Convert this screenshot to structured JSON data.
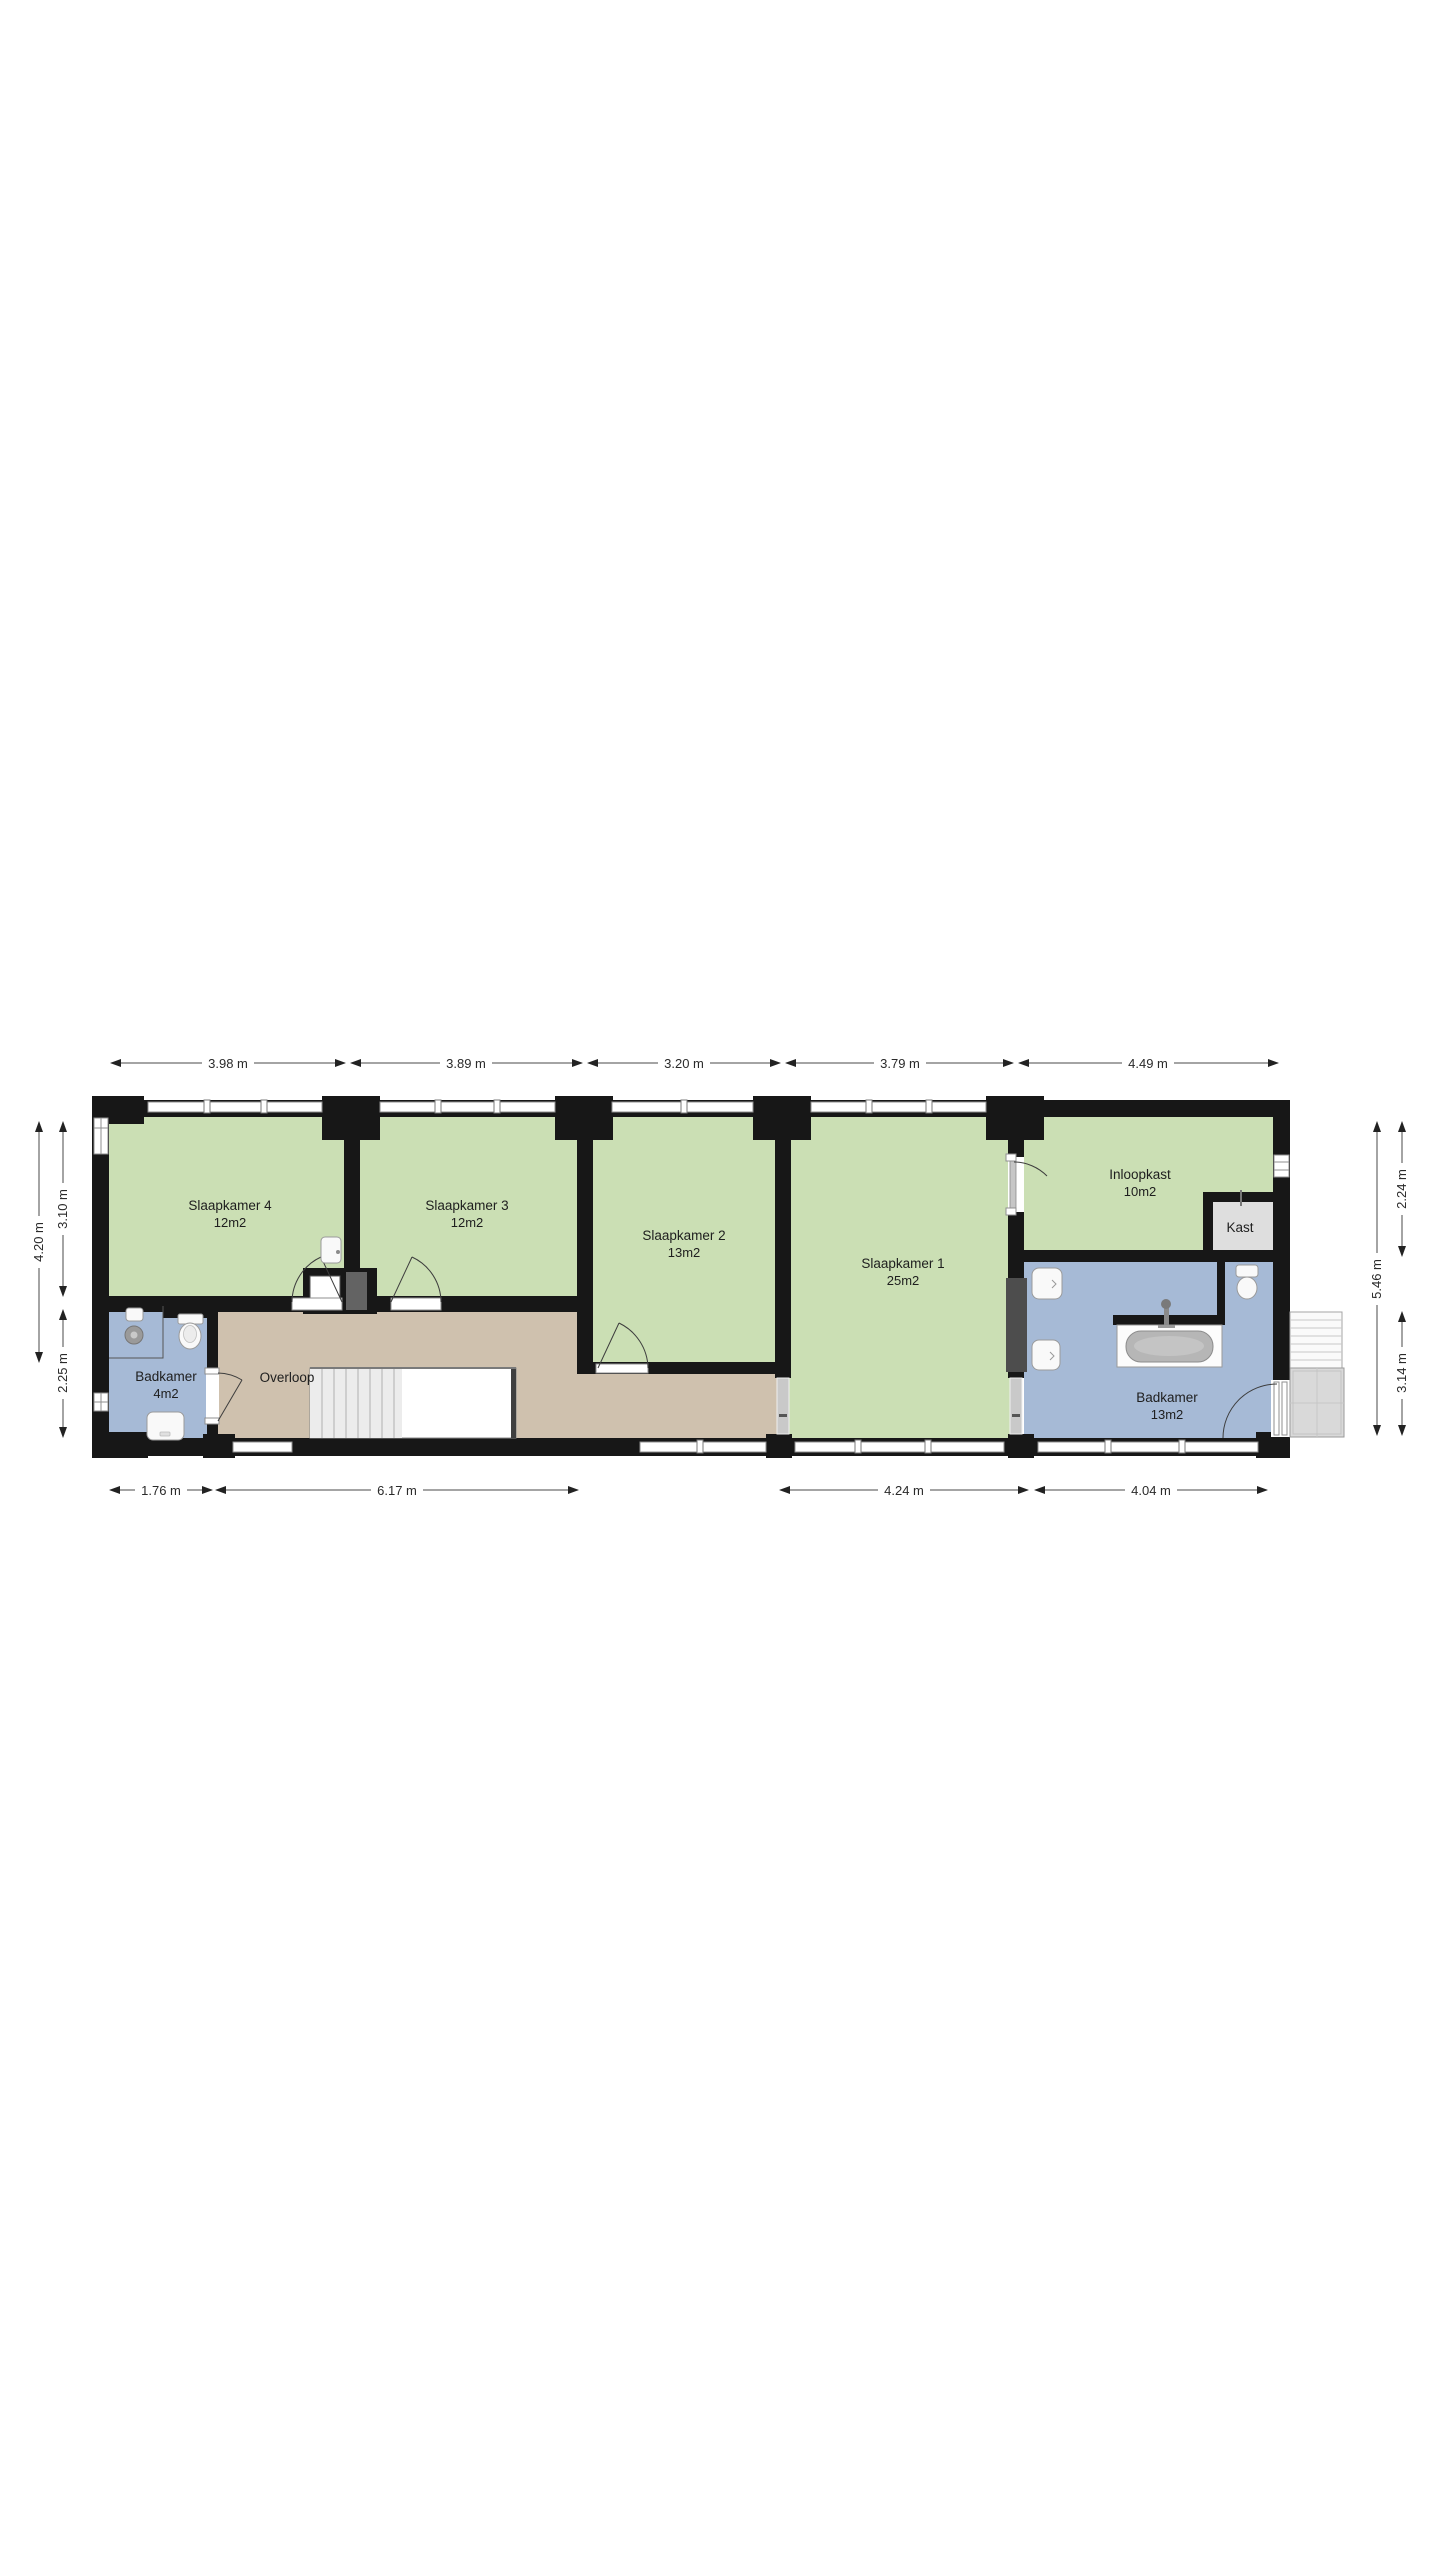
{
  "floorplan": {
    "rooms": [
      {
        "name": "Slaapkamer 4",
        "area": "12m2"
      },
      {
        "name": "Slaapkamer 3",
        "area": "12m2"
      },
      {
        "name": "Slaapkamer 2",
        "area": "13m2"
      },
      {
        "name": "Slaapkamer 1",
        "area": "25m2"
      },
      {
        "name": "Inloopkast",
        "area": "10m2"
      },
      {
        "name": "Kast",
        "area": ""
      },
      {
        "name": "Badkamer",
        "area": "4m2"
      },
      {
        "name": "Overloop",
        "area": ""
      },
      {
        "name": "Badkamer",
        "area": "13m2"
      }
    ],
    "dimensions": {
      "top": [
        "3.98 m",
        "3.89 m",
        "3.20 m",
        "3.79 m",
        "4.49 m"
      ],
      "bottom": [
        "1.76 m",
        "6.17 m",
        "4.24 m",
        "4.04 m"
      ],
      "left": [
        "4.20 m",
        "3.10 m",
        "2.25 m"
      ],
      "right": [
        "2.24 m",
        "5.46 m",
        "3.14 m"
      ]
    },
    "colors": {
      "bedroom_green": "#cbdfb4",
      "bathroom_blue": "#a6bad6",
      "hallway_tan": "#cfc1ae",
      "closet_gray": "#dedede",
      "wall_black": "#171717"
    }
  }
}
